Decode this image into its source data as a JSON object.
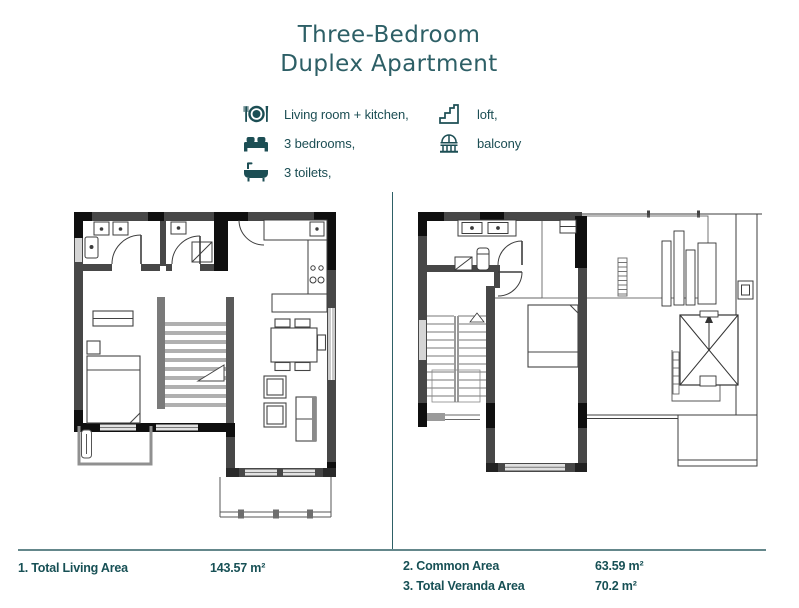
{
  "title": {
    "line1": "Three-Bedroom",
    "line2": "Duplex Apartment"
  },
  "legend": {
    "left": [
      {
        "icon": "dining-icon",
        "label": "Living room + kitchen,"
      },
      {
        "icon": "bed-icon",
        "label": "3 bedrooms,"
      },
      {
        "icon": "bathtub-icon",
        "label": "3 toilets,"
      }
    ],
    "right": [
      {
        "icon": "stairs-icon",
        "label": "loft,"
      },
      {
        "icon": "balcony-icon",
        "label": "balcony"
      }
    ]
  },
  "plans": [
    {
      "name": "first-floor-plan"
    },
    {
      "name": "loft-floor-plan"
    }
  ],
  "footer": {
    "stats": [
      {
        "label": "1. Total Living Area",
        "value": "143.57 m²"
      },
      {
        "label": "2. Common Area",
        "value": "63.59 m²"
      },
      {
        "label": "3. Total Veranda Area",
        "value": "70.2 m²"
      }
    ]
  },
  "colors": {
    "title_teal": "#2d5f66",
    "accent_teal": "#1c4e54",
    "footer_teal": "#175055",
    "rule_gray_teal": "#64878b",
    "wall_gray": "#474747",
    "wall_black": "#0f0f0f"
  }
}
